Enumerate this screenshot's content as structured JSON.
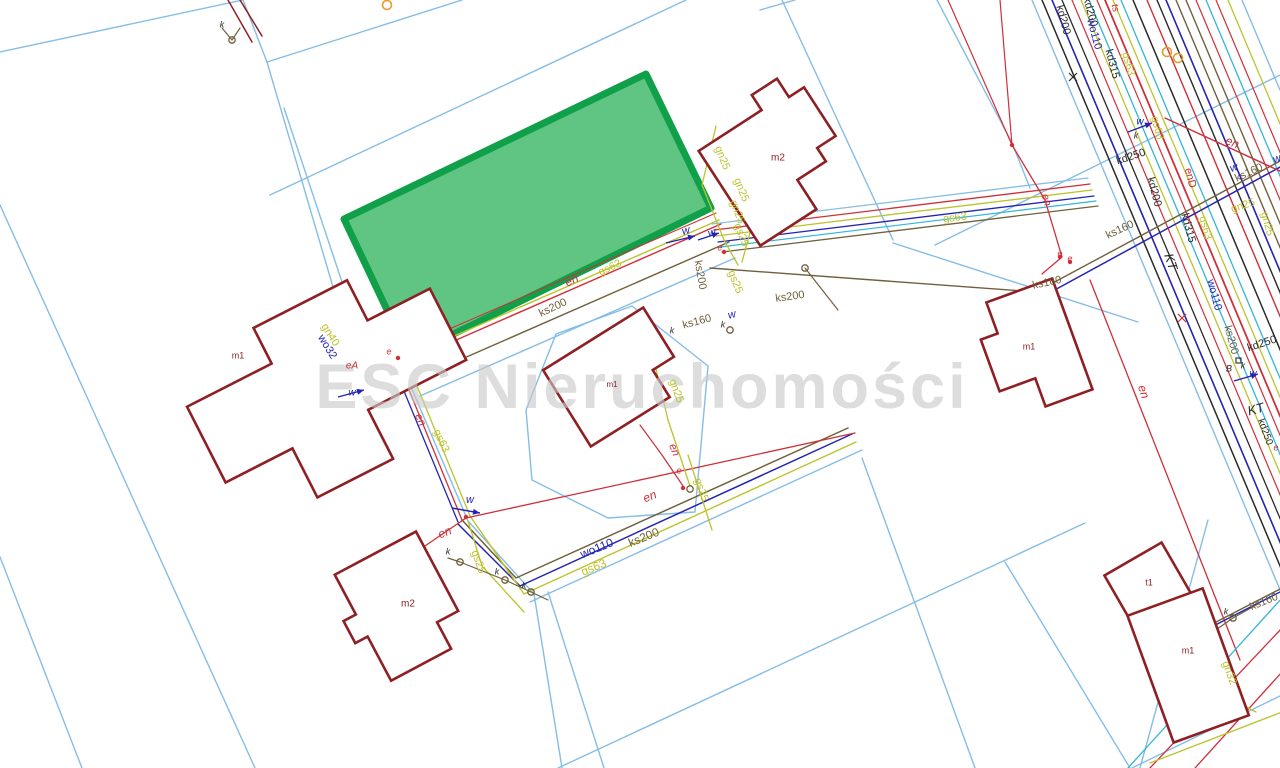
{
  "watermark": {
    "text": "ESC Nieruchomości",
    "color": "#c9c9c9",
    "size": 63,
    "x": 642,
    "y": 408
  },
  "colors": {
    "lb": "#85bde6",
    "bl": "#2424b4",
    "cy": "#33b5da",
    "rd": "#cf2f38",
    "yl": "#bcc32d",
    "br": "#70603c",
    "bk": "#2a2a2a",
    "bd": "#8e2023",
    "og": "#e59b2c",
    "green_fill": "#57c27b",
    "green_stroke": "#10a04a"
  },
  "map": {
    "green_parcel": {
      "name": "highlighted-offer-parcel",
      "points": "646,74 711,208 429,346 397,331 344,219"
    },
    "parcel_lines": [
      {
        "c": "lb",
        "w": 1.4,
        "p": "243,0 267,62"
      },
      {
        "c": "lb",
        "w": 1.4,
        "p": "267,62 462,0"
      },
      {
        "c": "lb",
        "w": 1.4,
        "p": "267,62 350,345"
      },
      {
        "c": "lb",
        "w": 1.4,
        "p": "284,108 364,348"
      },
      {
        "c": "lb",
        "w": 1.4,
        "p": "0,52 243,0"
      },
      {
        "c": "lb",
        "w": 1.4,
        "p": "0,205 255,768"
      },
      {
        "c": "lb",
        "w": 1.4,
        "p": "0,557 82,768"
      },
      {
        "c": "lb",
        "w": 1.4,
        "p": "270,195 686,0"
      },
      {
        "c": "lb",
        "w": 1.4,
        "p": "782,0 893,240"
      },
      {
        "c": "lb",
        "w": 1.4,
        "p": "893,243 1138,322"
      },
      {
        "c": "lb",
        "w": 1.4,
        "p": "935,245 1280,75"
      },
      {
        "c": "lb",
        "w": 1.4,
        "p": "937,0 1012,143 1030,188"
      },
      {
        "c": "lb",
        "w": 1.4,
        "p": "760,10 795,0"
      },
      {
        "c": "lb",
        "w": 1.4,
        "p": "632,306 708,366 695,512 608,518 532,480 526,410 556,334 632,306"
      },
      {
        "c": "lb",
        "w": 1.4,
        "p": "352,348 400,361 468,521 534,594 562,768"
      },
      {
        "c": "lb",
        "w": 1.4,
        "p": "548,592 604,768"
      },
      {
        "c": "lb",
        "w": 1.4,
        "p": "530,602 862,450"
      },
      {
        "c": "lb",
        "w": 1.4,
        "p": "862,458 975,768"
      },
      {
        "c": "lb",
        "w": 1.4,
        "p": "558,768 1085,523"
      },
      {
        "c": "lb",
        "w": 1.4,
        "p": "1005,562 1130,768"
      },
      {
        "c": "lb",
        "w": 1.4,
        "p": "1208,520 1140,768"
      },
      {
        "c": "lb",
        "w": 1.4,
        "p": "420,396 735,258"
      },
      {
        "c": "lb",
        "w": 1.4,
        "p": "1132,768 1282,695"
      },
      {
        "c": "lb",
        "w": 1.4,
        "p": "1032,0 1355,768"
      },
      {
        "c": "lb",
        "w": 1.4,
        "p": "1242,0 1280,90"
      }
    ],
    "utility_lines": [
      {
        "c": "bk",
        "w": 1.5,
        "p": "1042,0 1365,768"
      },
      {
        "c": "bl",
        "w": 1.6,
        "p": "1052,0 1375,768"
      },
      {
        "c": "bk",
        "w": 1.3,
        "p": "1062,0 1385,768"
      },
      {
        "c": "rd",
        "w": 1.2,
        "p": "1072,0 1395,768"
      },
      {
        "c": "yl",
        "w": 1.3,
        "p": "1081,0 1404,768"
      },
      {
        "c": "cy",
        "w": 1.3,
        "p": "1089,0 1412,768"
      },
      {
        "c": "rd",
        "w": 1.2,
        "p": "1097,0 1420,768"
      },
      {
        "c": "rd",
        "w": 1.8,
        "p": "1105,0 1428,768"
      },
      {
        "c": "yl",
        "w": 1.3,
        "p": "1113,0 1436,768"
      },
      {
        "c": "cy",
        "w": 1.3,
        "p": "1121,0 1444,768"
      },
      {
        "c": "bk",
        "w": 1.5,
        "p": "1133,0 1456,768"
      },
      {
        "c": "rd",
        "w": 1.4,
        "p": "1147,0 1470,768"
      },
      {
        "c": "bk",
        "w": 1.4,
        "p": "1157,0 1480,768"
      },
      {
        "c": "bl",
        "w": 1.6,
        "p": "1166,0 1489,768"
      },
      {
        "c": "br",
        "w": 1.4,
        "p": "1176,0 1499,768"
      },
      {
        "c": "br",
        "w": 1.4,
        "p": "1186,0 1509,768"
      },
      {
        "c": "rd",
        "w": 1.2,
        "p": "1196,0 1519,768"
      },
      {
        "c": "cy",
        "w": 1.3,
        "p": "1206,0 1529,768"
      },
      {
        "c": "rd",
        "w": 1.2,
        "p": "1216,0 1539,768"
      },
      {
        "c": "yl",
        "w": 1.3,
        "p": "1228,0 1551,768"
      },
      {
        "c": "rd",
        "w": 1.0,
        "p": "401,350 716,213"
      },
      {
        "c": "yl",
        "w": 1.4,
        "p": "404,358 719,220"
      },
      {
        "c": "rd",
        "w": 1.4,
        "p": "406,362 721,224"
      },
      {
        "c": "br",
        "w": 1.4,
        "p": "414,380 729,242"
      },
      {
        "c": "lb",
        "w": 1.3,
        "p": "712,224 1088,178"
      },
      {
        "c": "rd",
        "w": 1.3,
        "p": "714,230 1090,184"
      },
      {
        "c": "yl",
        "w": 1.3,
        "p": "716,236 1092,190"
      },
      {
        "c": "bl",
        "w": 1.3,
        "p": "718,242 1094,196"
      },
      {
        "c": "cy",
        "w": 1.2,
        "p": "720,247 1096,201"
      },
      {
        "c": "br",
        "w": 1.3,
        "p": "722,252 1098,206"
      },
      {
        "c": "br",
        "w": 1.4,
        "p": "710,268 1036,292"
      },
      {
        "c": "br",
        "w": 1.4,
        "p": "1036,292 1282,160"
      },
      {
        "c": "bl",
        "w": 1.5,
        "p": "1040,298 1282,166"
      },
      {
        "c": "rd",
        "w": 1.4,
        "p": "1165,118 1282,172"
      },
      {
        "c": "rd",
        "w": 1.2,
        "p": "948,0 1012,145"
      },
      {
        "c": "rd",
        "w": 1.2,
        "p": "1000,0 1012,145"
      },
      {
        "c": "rd",
        "w": 1.3,
        "p": "1012,145 1045,200 1062,257 1042,274"
      },
      {
        "c": "rd",
        "w": 1.3,
        "p": "1090,280 1240,660"
      },
      {
        "c": "rd",
        "w": 1.3,
        "p": "396,358 462,520"
      },
      {
        "c": "yl",
        "w": 1.3,
        "p": "404,354 470,516"
      },
      {
        "c": "bl",
        "w": 1.3,
        "p": "392,362 458,522"
      },
      {
        "c": "br",
        "w": 1.5,
        "p": "462,520 516,578 848,428"
      },
      {
        "c": "bl",
        "w": 1.5,
        "p": "458,524 520,586 852,434"
      },
      {
        "c": "yl",
        "w": 1.4,
        "p": "470,516 524,594 856,442"
      },
      {
        "c": "rd",
        "w": 1.3,
        "p": "466,518 855,433"
      },
      {
        "c": "rd",
        "w": 1.3,
        "p": "400,563 466,518"
      },
      {
        "c": "yl",
        "w": 1.3,
        "p": "468,521 482,566 524,612"
      },
      {
        "c": "br",
        "w": 1.2,
        "p": "448,558 460,562 505,580 531,592 548,600"
      },
      {
        "c": "yl",
        "w": 1.3,
        "p": "652,352 668,420 690,486"
      },
      {
        "c": "rd",
        "w": 1.2,
        "p": "640,425 662,455 683,486"
      },
      {
        "c": "yl",
        "w": 1.3,
        "p": "688,455 712,530"
      },
      {
        "c": "yl",
        "w": 1.3,
        "p": "716,126 702,185 724,240 738,265"
      },
      {
        "c": "yl",
        "w": 1.3,
        "p": "746,168 752,225 742,262"
      },
      {
        "c": "yl",
        "w": 1.3,
        "p": "312,308 398,356"
      },
      {
        "c": "bl",
        "w": 1.3,
        "p": "300,325 398,362"
      },
      {
        "c": "rd",
        "w": 1.3,
        "p": "1150,768 1282,628"
      },
      {
        "c": "rd",
        "w": 1.3,
        "p": "1195,768 1282,672"
      },
      {
        "c": "cy",
        "w": 1.3,
        "p": "1128,768 1282,598"
      },
      {
        "c": "br",
        "w": 1.4,
        "p": "1185,638 1282,588"
      },
      {
        "c": "bl",
        "w": 1.4,
        "p": "1182,642 1280,592"
      },
      {
        "c": "yl",
        "w": 1.3,
        "p": "1150,763 1282,712"
      },
      {
        "c": "yl",
        "w": 1.3,
        "p": "1222,640 1233,700 1256,712"
      },
      {
        "c": "bd",
        "w": 1.5,
        "p": "228,0 252,42"
      },
      {
        "c": "bd",
        "w": 1.5,
        "p": "240,0 262,36"
      },
      {
        "c": "br",
        "w": 1.2,
        "p": "805,268 838,310"
      },
      {
        "c": "br",
        "w": 1.2,
        "p": "1207,636 1233,618 1258,604"
      },
      {
        "c": "br",
        "w": 1.2,
        "p": "222,28 232,40 240,28"
      }
    ],
    "buildings": [
      {
        "id": "building-m1-left",
        "d": "M195,340 L290,340 L290,300 L395,300 L395,345 L465,345 L465,425 L355,425 L355,480 L270,480 L270,425 L195,425 Z",
        "rot": "-27 330 390"
      },
      {
        "id": "building-m2-top",
        "d": "M715,110 L790,110 L790,92 L820,92 L820,114 L838,114 L838,172 L816,172 L816,188 L782,188 L782,223 L715,223 Z",
        "rot": "-33 776 158"
      },
      {
        "id": "building-m1-center",
        "d": "M558,332 L676,332 L676,390 L651,390 L651,422 L558,422 Z",
        "rot": "-32 617 377"
      },
      {
        "id": "building-m2-bottom",
        "d": "M358,548 L450,548 L450,638 L426,638 L426,668 L358,668 L358,618 L344,618 L344,593 L358,593 Z",
        "rot": "-28 400 608"
      },
      {
        "id": "building-m1-right",
        "d": "M1005,290 L1075,290 L1075,408 L1025,408 L1025,378 L987,378 L987,323 L1005,323 Z",
        "rot": "-20 1031 349"
      },
      {
        "id": "building-t1",
        "d": "M1115,555 L1181,555 L1181,615 L1115,615 Z",
        "rot": "-30 1148 585"
      },
      {
        "id": "building-m1-bottomright",
        "d": "M1148,598 L1228,598 L1228,733 L1148,733 Z",
        "rot": "-20 1188 665"
      }
    ],
    "labels": [
      [
        "kd200",
        1063,
        20,
        75,
        "bk",
        11
      ],
      [
        "kd200",
        1090,
        12,
        75,
        "bk",
        11
      ],
      [
        "wo110",
        1094,
        34,
        75,
        "bl",
        11
      ],
      [
        "kd315",
        1112,
        64,
        75,
        "bk",
        11
      ],
      [
        "gs63",
        1128,
        64,
        75,
        "yl",
        11
      ],
      [
        "ts",
        1115,
        8,
        75,
        "rd",
        10
      ],
      [
        "gs63",
        1157,
        128,
        75,
        "yl",
        11
      ],
      [
        "kd250",
        1131,
        157,
        -18,
        "bk",
        11
      ],
      [
        "kd200",
        1154,
        192,
        75,
        "bk",
        11
      ],
      [
        "enD",
        1190,
        178,
        75,
        "rd",
        11
      ],
      [
        "kd315",
        1188,
        228,
        75,
        "bk",
        11
      ],
      [
        "wo110",
        1214,
        295,
        75,
        "bl",
        11
      ],
      [
        "ks200",
        1231,
        340,
        75,
        "br",
        11
      ],
      [
        "kd250",
        1262,
        344,
        -18,
        "bk",
        11
      ],
      [
        "KT",
        1170,
        262,
        72,
        "bk",
        13
      ],
      [
        "KT",
        1256,
        410,
        -15,
        "bk",
        13
      ],
      [
        "en",
        1232,
        143,
        22,
        "rd",
        12
      ],
      [
        "en",
        1046,
        200,
        75,
        "rd",
        11
      ],
      [
        "w",
        1234,
        168,
        -20,
        "bl",
        11
      ],
      [
        "ks160",
        1249,
        173,
        -25,
        "br",
        11
      ],
      [
        "w",
        1277,
        159,
        -20,
        "bl",
        11
      ],
      [
        "gn25",
        1243,
        206,
        -18,
        "yl",
        11
      ],
      [
        "gn25",
        1267,
        224,
        75,
        "yl",
        11
      ],
      [
        "gs63",
        1205,
        228,
        75,
        "yl",
        11
      ],
      [
        "ks160",
        1120,
        230,
        -25,
        "br",
        11
      ],
      [
        "ks160",
        1047,
        283,
        -12,
        "br",
        11
      ],
      [
        "en",
        1143,
        392,
        72,
        "rd",
        12
      ],
      [
        "kd250",
        1265,
        432,
        70,
        "bk",
        10
      ],
      [
        "e",
        1276,
        448,
        0,
        "rd",
        9
      ],
      [
        "e",
        1060,
        254,
        0,
        "rd",
        9
      ],
      [
        "e",
        1070,
        259,
        0,
        "rd",
        9
      ],
      [
        "w",
        1140,
        122,
        0,
        "bl",
        10
      ],
      [
        "k",
        1136,
        136,
        0,
        "bk",
        9
      ],
      [
        "B",
        1229,
        369,
        0,
        "bk",
        9
      ],
      [
        "k",
        1243,
        366,
        0,
        "bk",
        9
      ],
      [
        "w",
        1253,
        374,
        0,
        "bl",
        10
      ],
      [
        "gs63",
        955,
        218,
        -7,
        "yl",
        11
      ],
      [
        "ks200",
        790,
        297,
        -8,
        "br",
        11
      ],
      [
        "gs63",
        610,
        268,
        -25,
        "yl",
        11
      ],
      [
        "en",
        572,
        281,
        -25,
        "rd",
        12
      ],
      [
        "ks200",
        553,
        308,
        -25,
        "br",
        11
      ],
      [
        "ks200",
        700,
        275,
        80,
        "br",
        11
      ],
      [
        "ks160",
        697,
        322,
        -15,
        "br",
        11
      ],
      [
        "k",
        672,
        331,
        0,
        "bk",
        9
      ],
      [
        "k",
        723,
        325,
        0,
        "bk",
        9
      ],
      [
        "w",
        686,
        231,
        -15,
        "bl",
        11
      ],
      [
        "w",
        712,
        233,
        -15,
        "bl",
        11
      ],
      [
        "w",
        732,
        315,
        -15,
        "bl",
        11
      ],
      [
        "e",
        720,
        248,
        0,
        "rd",
        9
      ],
      [
        "gn25",
        722,
        158,
        68,
        "yl",
        11
      ],
      [
        "gn25",
        741,
        190,
        68,
        "yl",
        11
      ],
      [
        "gn25",
        737,
        212,
        68,
        "yl",
        11
      ],
      [
        "gs25",
        741,
        235,
        68,
        "yl",
        11
      ],
      [
        "gs25",
        735,
        282,
        68,
        "yl",
        11
      ],
      [
        "gn40",
        330,
        335,
        58,
        "yl",
        11
      ],
      [
        "wo32",
        327,
        347,
        58,
        "bl",
        11
      ],
      [
        "eA",
        352,
        366,
        0,
        "rd",
        10
      ],
      [
        "e",
        389,
        352,
        0,
        "rd",
        9
      ],
      [
        "w",
        352,
        393,
        0,
        "bl",
        10
      ],
      [
        "en",
        420,
        420,
        65,
        "rd",
        11
      ],
      [
        "gs63",
        441,
        441,
        65,
        "yl",
        11
      ],
      [
        "en",
        445,
        533,
        -22,
        "rd",
        12
      ],
      [
        "w",
        470,
        500,
        0,
        "bl",
        11
      ],
      [
        "k",
        448,
        552,
        0,
        "bk",
        9
      ],
      [
        "k",
        497,
        572,
        0,
        "bk",
        9
      ],
      [
        "k",
        524,
        586,
        0,
        "bk",
        9
      ],
      [
        "gs25",
        478,
        562,
        70,
        "yl",
        11
      ],
      [
        "en",
        650,
        497,
        -22,
        "rd",
        12
      ],
      [
        "wo110",
        597,
        549,
        -22,
        "bl",
        12
      ],
      [
        "ks200",
        644,
        538,
        -22,
        "br",
        12
      ],
      [
        "gs63",
        594,
        568,
        -22,
        "yl",
        12
      ],
      [
        "gs25",
        701,
        490,
        70,
        "yl",
        11
      ],
      [
        "en",
        674,
        450,
        68,
        "rd",
        11
      ],
      [
        "e",
        679,
        471,
        0,
        "rd",
        9
      ],
      [
        "gn25",
        676,
        391,
        70,
        "yl",
        11
      ],
      [
        "k",
        1226,
        612,
        0,
        "bk",
        9
      ],
      [
        "ks160",
        1264,
        602,
        -22,
        "br",
        11
      ],
      [
        "gn32",
        1229,
        673,
        70,
        "yl",
        11
      ],
      [
        "k",
        222,
        25,
        0,
        "bk",
        9
      ],
      [
        "m1",
        238,
        356,
        0,
        "bd",
        9
      ],
      [
        "m2",
        778,
        158,
        0,
        "bd",
        10
      ],
      [
        "m1",
        612,
        385,
        0,
        "bd",
        8
      ],
      [
        "m2",
        408,
        604,
        0,
        "bd",
        10
      ],
      [
        "m1",
        1029,
        347,
        0,
        "bd",
        9
      ],
      [
        "t1",
        1149,
        583,
        0,
        "bd",
        9
      ],
      [
        "m1",
        1188,
        651,
        0,
        "bd",
        9
      ]
    ],
    "manholes": [
      [
        460,
        562
      ],
      [
        505,
        580
      ],
      [
        531,
        592
      ],
      [
        805,
        268
      ],
      [
        1233,
        618
      ],
      [
        232,
        40
      ],
      [
        730,
        330
      ],
      [
        690,
        489
      ]
    ],
    "e_dots": [
      [
        1060,
        257
      ],
      [
        1070,
        262
      ],
      [
        466,
        517
      ],
      [
        398,
        358
      ],
      [
        724,
        252
      ],
      [
        1012,
        145
      ],
      [
        683,
        488
      ]
    ],
    "orange_rings": [
      [
        387,
        5
      ],
      [
        1167,
        52
      ],
      [
        1178,
        58
      ]
    ],
    "crosses": [
      [
        1073,
        77,
        "bk"
      ],
      [
        1182,
        318,
        "rd"
      ]
    ],
    "b_squares": [
      [
        1236,
        358
      ]
    ],
    "water_arrows": [
      [
        452,
        508,
        480,
        513
      ],
      [
        666,
        243,
        695,
        236
      ],
      [
        698,
        240,
        719,
        233
      ],
      [
        1128,
        132,
        1152,
        123
      ],
      [
        1234,
        381,
        1258,
        374
      ],
      [
        338,
        397,
        364,
        390
      ]
    ]
  }
}
